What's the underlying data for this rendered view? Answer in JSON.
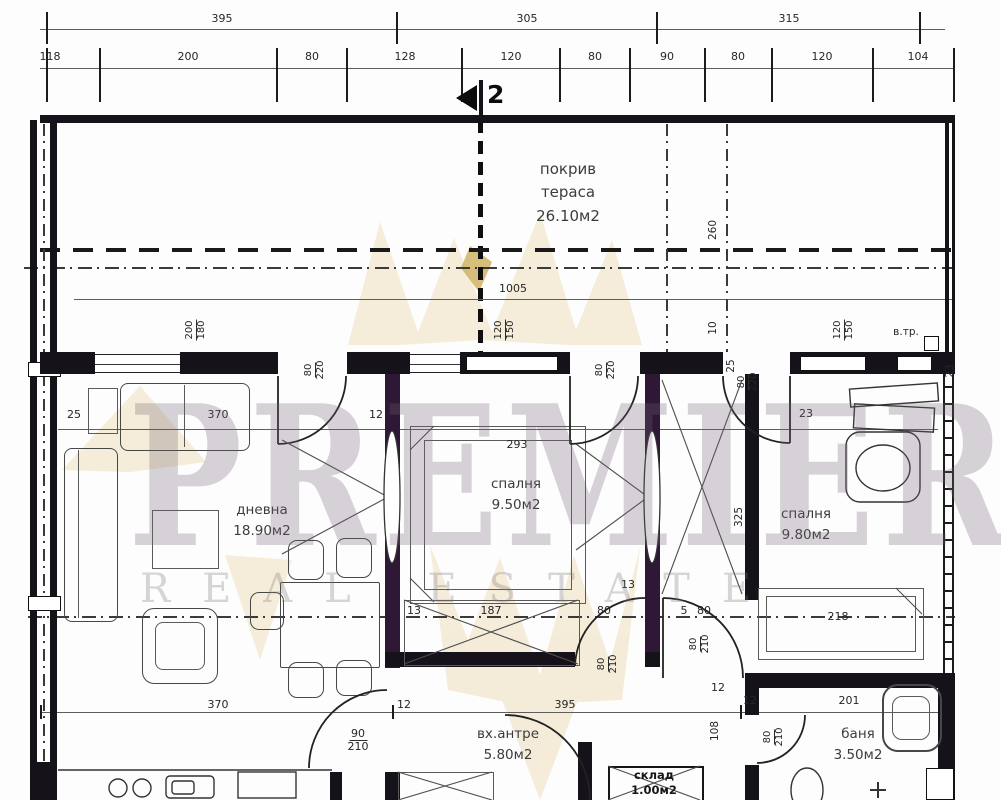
{
  "top": {
    "r1": [
      "395",
      "305",
      "315"
    ],
    "r2": [
      "118",
      "200",
      "80",
      "128",
      "120",
      "80",
      "90",
      "80",
      "120",
      "104"
    ]
  },
  "section": {
    "n": "2"
  },
  "terrace": {
    "l1": "покрив",
    "l2": "тераса",
    "area": "26.10м2",
    "w": "1005",
    "h": "260",
    "h2": "10",
    "winl": [
      "200",
      "180"
    ],
    "winm": [
      "120",
      "150"
    ],
    "winr": [
      "120",
      "150"
    ],
    "vtr": "в.тр."
  },
  "living": {
    "name": "дневна",
    "area": "18.90м2",
    "d25": "25",
    "d370": "370",
    "d12": "12",
    "b370": "370",
    "b12": "12",
    "doort": [
      "80",
      "220"
    ],
    "doorb": [
      "90",
      "210"
    ]
  },
  "bed1": {
    "name": "спалня",
    "area": "9.50м2",
    "w": "293",
    "doort": [
      "80",
      "220"
    ],
    "r13a": "13",
    "r187": "187",
    "r80": "80",
    "r13b": "13",
    "doorb": [
      "80",
      "210"
    ],
    "b395": "395"
  },
  "bed2": {
    "name": "спалня",
    "area": "9.80м2",
    "h": "325",
    "bed": "218",
    "d23": "23",
    "doort": [
      "25",
      "80",
      "220"
    ],
    "d5": "5",
    "d80": "80",
    "doorh": [
      "80",
      "210"
    ],
    "corner": "23"
  },
  "hall": {
    "name": "вх.антре",
    "area": "5.80м2",
    "d108": "108",
    "d12a": "12",
    "d12b": "12"
  },
  "bath": {
    "name": "баня",
    "area": "3.50м2",
    "w": "201",
    "door": [
      "80",
      "210"
    ]
  },
  "storage": {
    "name": "склад",
    "area": "1.00м2"
  },
  "wm": {
    "l1": "PREMIER",
    "l2": "REAL ESTATE"
  },
  "colors": {
    "wall": "#15121a",
    "wall_tint": "#2e1836",
    "dim_text": "#262626",
    "gold": "#e9d6a8",
    "watermark": "#8d8390"
  }
}
